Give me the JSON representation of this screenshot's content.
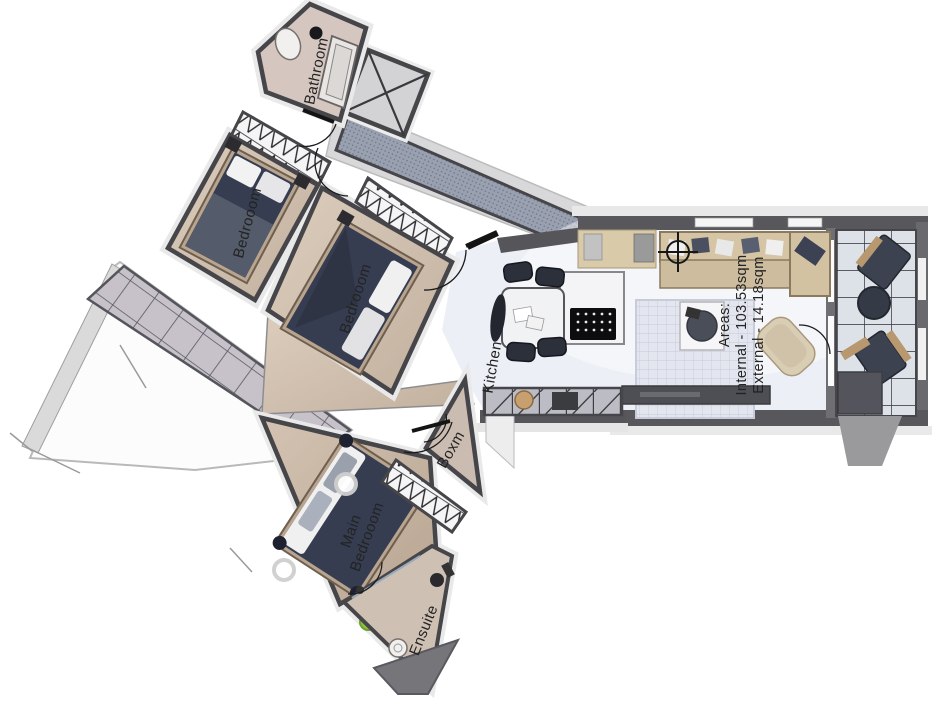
{
  "floorplan": {
    "rooms": {
      "bathroom": {
        "label": "Bathroom"
      },
      "bedroom1": {
        "label": "Bedrooom"
      },
      "bedroom2": {
        "label": "Bedrooom"
      },
      "kitchen": {
        "label": "Kitchen"
      },
      "boxroom": {
        "label": "Boxm"
      },
      "main_bedroom": {
        "line1": "Main",
        "line2": "Bedrooom"
      },
      "ensuite": {
        "label": "Ensuite"
      }
    },
    "areas": {
      "title": "Areas:",
      "internal": "Internal - 103.53sqm",
      "external": "External - 14.18sqm"
    },
    "colors": {
      "wall_dark": "#46464a",
      "wood_floor": "#d2c2b1",
      "living_floor": "#edeff6",
      "corridor": "#99a0b0",
      "bed_navy": "#363d51",
      "sofa_beige": "#d6c5a5",
      "terrace_tile": "#c7c2ca",
      "balcony_floor": "#dde1e8",
      "plant_green": "#8fbf3f"
    }
  }
}
